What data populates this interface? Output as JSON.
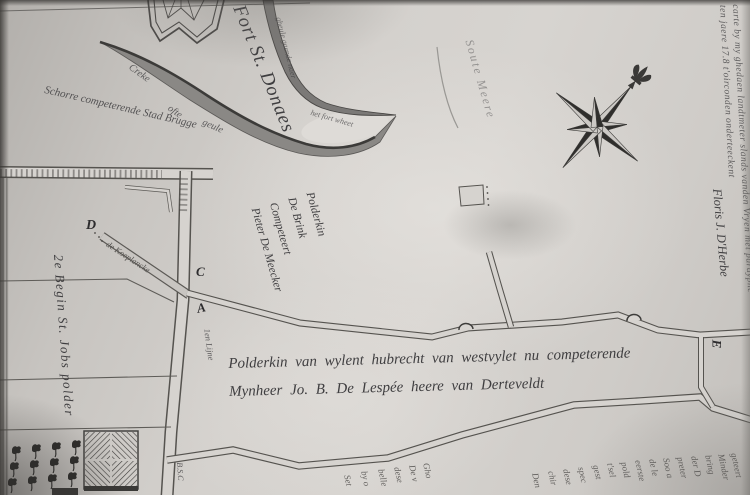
{
  "palette": {
    "paper": "#d4d1cd",
    "paper_dark": "#b2afab",
    "ink": "#3f3e40",
    "water": "#8a8885"
  },
  "labels": {
    "fort": "Fort St. Donaes",
    "marsh": "Schorre competerende Stad Brugge",
    "creek_a": "Creke",
    "creek_b": "ofte",
    "creek_c": "geule",
    "channel_upper": "gheule gaende naer",
    "channel_lower": "het fort wheet",
    "faint_water": "Soute Meere",
    "polder_column": "2e Begin St. Jobs polder",
    "koeplancke": "de Koeplancke",
    "linie": "1en Lijne",
    "bsc": "B.S.C",
    "brink": [
      "Polderkin",
      "De Brink",
      "Competeert",
      "Pieter De Meecker"
    ],
    "inscription1": "Polderkin van wylent hubrecht van westvylet nu competerende",
    "inscription2": "Mynheer Jo. B. De Lespée heere van Derteveldt",
    "markers": {
      "A": "A",
      "C": "C",
      "D": "D",
      "E": "E"
    },
    "attestation1": "carte by my ghedaen landtmeter slands vanden Vryen met parayphe",
    "attestation2": "ten jaere 17.8 t'oirconden onderteeckent",
    "signature": "Floris J. D'Herbe",
    "fragments": [
      "Set",
      "by o",
      "belle",
      "dese",
      "De v",
      "Gho",
      "Den",
      "chir",
      "dese",
      "spec",
      "gest",
      "t'sel",
      "pold",
      "eerste",
      "de le",
      "Soo a",
      "preter",
      "der D",
      "bring",
      "Minder",
      "geteert"
    ]
  }
}
